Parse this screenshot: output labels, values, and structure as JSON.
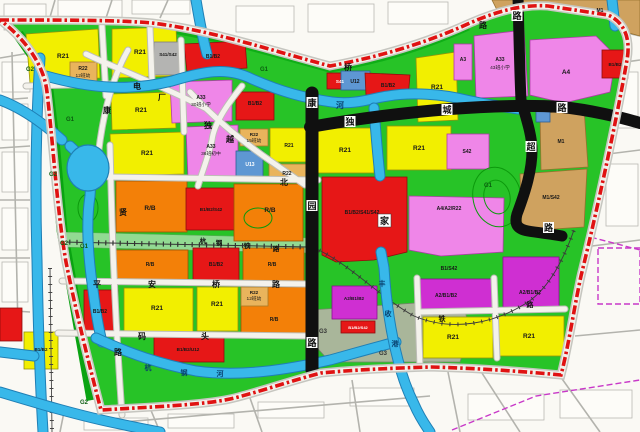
{
  "colors": {
    "residential_r21": "#f2ef00",
    "kindergarten_r22": "#e9b45c",
    "commercial_b": "#e61717",
    "public_a": "#ef86e8",
    "mixed_a2": "#cf2fd2",
    "mixed_rb": "#f38008",
    "utility_u": "#5e97d3",
    "industry_m1": "#cfa25f",
    "green_g": "#27c327",
    "water": "#38b8ea",
    "boundary": "#e01212"
  },
  "parcels": [
    {
      "code": "R21"
    },
    {
      "code": "R21"
    },
    {
      "code": "R21"
    },
    {
      "code": "R21"
    },
    {
      "code": "R22",
      "detail": "12班幼"
    },
    {
      "code": "S41/S42"
    },
    {
      "code": "B1/B2"
    },
    {
      "code": "B1/B2"
    },
    {
      "code": "A33",
      "detail": "30班小学"
    },
    {
      "code": "A33",
      "detail": "36班初中"
    },
    {
      "code": "R22",
      "detail": "15班幼"
    },
    {
      "code": "R21"
    },
    {
      "code": "R22"
    },
    {
      "code": "U13"
    },
    {
      "code": "S41"
    },
    {
      "code": "U12"
    },
    {
      "code": "B1/B2"
    },
    {
      "code": "R21"
    },
    {
      "code": "R21"
    },
    {
      "code": "R21"
    },
    {
      "code": "A3"
    },
    {
      "code": "A33",
      "detail": "43班小学"
    },
    {
      "code": "A4"
    },
    {
      "code": "M1"
    },
    {
      "code": "B1/B2"
    },
    {
      "code": "S42"
    },
    {
      "code": "M1"
    },
    {
      "code": "M1/S42"
    },
    {
      "code": "R/B"
    },
    {
      "code": "B1/B2/S42"
    },
    {
      "code": "R/B"
    },
    {
      "code": "B1/B2/S41/S42"
    },
    {
      "code": "A4/A2/R22"
    },
    {
      "code": "B1/S42"
    },
    {
      "code": "R/B"
    },
    {
      "code": "B1/B2"
    },
    {
      "code": "R/B"
    },
    {
      "code": "B1/B2"
    },
    {
      "code": "R21"
    },
    {
      "code": "R21"
    },
    {
      "code": "R22",
      "detail": "12班幼"
    },
    {
      "code": "R/B"
    },
    {
      "code": "B1/B2/U12"
    },
    {
      "code": "B1/B2"
    },
    {
      "code": "A2/B1/B2"
    },
    {
      "code": "A2/B1/B2"
    },
    {
      "code": "A2/B1/B2"
    },
    {
      "code": "R21"
    },
    {
      "code": "R21"
    },
    {
      "code": "B1/B2/S42"
    }
  ],
  "zone_labels": {
    "g1": "G1",
    "g2": "G2",
    "g3": "G3"
  },
  "roads": {
    "kangyuan": [
      "康",
      "园",
      "路"
    ],
    "ducheng": [
      "独",
      "城",
      "路"
    ],
    "chao": [
      "超",
      "路"
    ],
    "top_lu": "路",
    "outer_lu": "路",
    "outer_qiao": "桥",
    "xian": [
      "贤",
      "路"
    ],
    "pinganqiao": [
      "平",
      "安",
      "桥",
      "路"
    ],
    "matou": [
      "码",
      "头"
    ],
    "bei": "北",
    "duyue": [
      "独",
      "越"
    ],
    "kang": "康",
    "dianchang": [
      "电",
      "厂"
    ],
    "hanggang_rail": [
      "杭",
      "钢",
      "铁",
      "路"
    ],
    "railway": [
      "铁",
      "路"
    ],
    "jia": "家"
  },
  "waterways": {
    "he": "河",
    "hanggang_river": [
      "杭",
      "钢",
      "河"
    ],
    "fengshou": [
      "丰",
      "收",
      "港"
    ]
  }
}
